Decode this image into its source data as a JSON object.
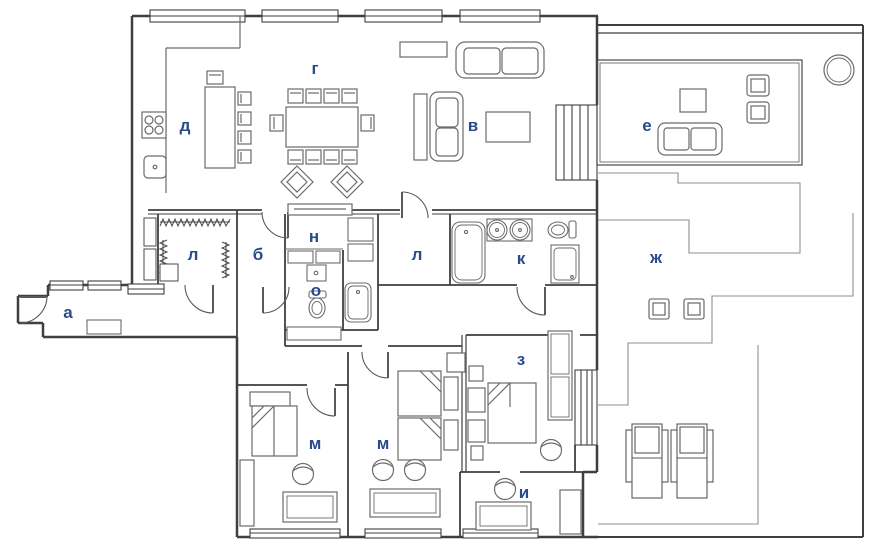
{
  "title": "Apartment floor plan",
  "palette": {
    "wall": "#3f3f3f",
    "furniture": "#6b6b6b",
    "light_line": "#8f8f8f",
    "label": "#2b4a8c",
    "background": "#ffffff"
  },
  "rooms": [
    {
      "id": "g",
      "label": "г"
    },
    {
      "id": "d",
      "label": "д"
    },
    {
      "id": "v",
      "label": "в"
    },
    {
      "id": "e",
      "label": "е"
    },
    {
      "id": "l1",
      "label": "л"
    },
    {
      "id": "b",
      "label": "б"
    },
    {
      "id": "n",
      "label": "н"
    },
    {
      "id": "l2",
      "label": "л"
    },
    {
      "id": "k",
      "label": "к"
    },
    {
      "id": "zh",
      "label": "ж"
    },
    {
      "id": "o",
      "label": "о"
    },
    {
      "id": "a",
      "label": "а"
    },
    {
      "id": "m1",
      "label": "м"
    },
    {
      "id": "m2",
      "label": "м"
    },
    {
      "id": "z",
      "label": "з"
    },
    {
      "id": "i",
      "label": "и"
    }
  ]
}
